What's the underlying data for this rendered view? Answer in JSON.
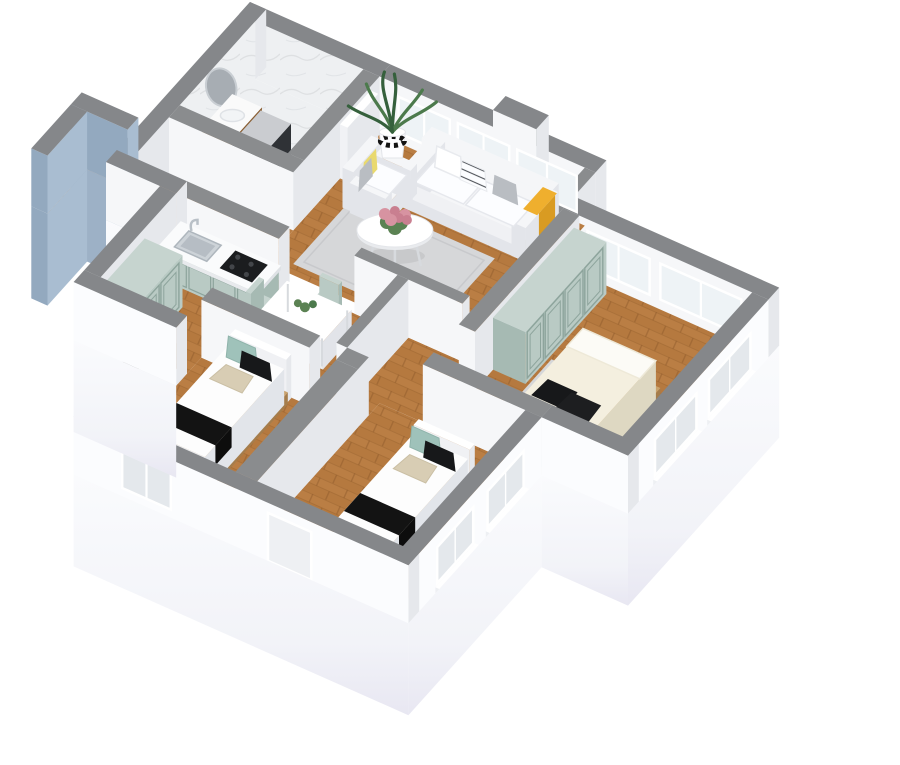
{
  "scene": {
    "description": "3D isometric dollhouse render of an apartment floor plan on a white background, gray-capped cutaway walls, wood floors",
    "rooms": [
      {
        "name": "bathroom",
        "position": "top-left",
        "floor": "white marble",
        "walls": "white marble",
        "furniture": [
          "round wall mirror",
          "wood vanity with sink basin",
          "washing machine"
        ]
      },
      {
        "name": "living-room",
        "position": "top-center",
        "floor": "wood",
        "windows": "three framed windows on north wall",
        "furniture": [
          "white three-seat sofa with white, striped and gray pillows and yellow throw",
          "white armchair with yellow and gray pillows",
          "round white coffee table with pink flower centerpiece",
          "gray area rug",
          "tall green plant in white pot with black checker band",
          "open white door to bathroom"
        ]
      },
      {
        "name": "kitchen-dining",
        "position": "center-left",
        "floor": "wood",
        "furniture": [
          "sage green kitchen counter with steel sink, faucet and black cooktop",
          "white dining table with four sage green chairs and green centerpiece"
        ]
      },
      {
        "name": "hallway",
        "position": "left",
        "floor": "wood",
        "furniture": [
          "sage green wardrobe"
        ],
        "exterior": "blue-gray entry niche panel on west side"
      },
      {
        "name": "master-bedroom",
        "position": "right",
        "floor": "wood",
        "windows": "north wall windows and two east windows with outside sills",
        "furniture": [
          "sage green four-door wardrobe",
          "double bed with cream duvet, white folded sheet, two black pillows and gray headboard",
          "gray rug"
        ]
      },
      {
        "name": "bedroom-2",
        "position": "bottom-center",
        "floor": "wood",
        "furniture": [
          "single bed with white mattress, black stripe blanket, teal, black and beige pillows, wood base"
        ]
      },
      {
        "name": "bedroom-3",
        "position": "bottom-right",
        "floor": "wood",
        "windows": "two east windows and south window and door opening with sills",
        "furniture": [
          "single bed with white mattress, black stripe blanket, teal, black and beige pillows, wood base"
        ]
      }
    ]
  },
  "palette": {
    "bg": "#ffffff",
    "wallTop": "#8a8c8e",
    "wallTopExt": "#85878a",
    "wallFace": "#f6f7f9",
    "wallShade": "#e6e8ec",
    "extFace": "#fbfcfe",
    "skirtTop": "#fafbfd",
    "skirtMid": "#f2f3f8",
    "skirtBottom": "#e8e7f2",
    "wood": "#b5793f",
    "woodLight": "#bd8148",
    "woodDark": "#9c6630",
    "woodSeam": "#8f5c2c",
    "marble": "#eef0f2",
    "marbleVein": "#d9dcdf",
    "sage": "#b9cac4",
    "sageShade": "#a6bab3",
    "sageTop": "#c6d4cf",
    "sageLine": "#8da49c",
    "sofa": "#f5f6f8",
    "sofaShade": "#e3e5ea",
    "sofaDark": "#d7dade",
    "cushion": "#fcfdff",
    "rug": "#d6d7d9",
    "rugLine": "#c8c9cc",
    "bedWood": "#c9a26c",
    "bedWoodShade": "#b18a56",
    "duvet": "#fdfdfd",
    "duvetShade": "#eceef2",
    "duvetDark": "#e2e5ea",
    "duvetCream": "#f4efdf",
    "creamShade": "#e6e0cc",
    "creamDark": "#ded8c2",
    "black": "#131313",
    "teal": "#9fc2ba",
    "beige": "#d8cdb4",
    "grayPillow": "#b9bdc2",
    "yellow": "#e9d96e",
    "yellowDeep": "#efaf2e",
    "yellowShade": "#d99b22",
    "steel": "#cdd3d8",
    "steelDark": "#aeb6bd",
    "cooktop": "#1b1d1f",
    "cabinetWood": "#a97c46",
    "cabinetWoodShade": "#8a5f34",
    "washer": "#3a3d41",
    "washerShade": "#2f3236",
    "washerTop": "#caccd0",
    "niche": "#a9bdd1",
    "nicheShade": "#93a9bf",
    "nicheSkirt": "#9db1c6",
    "mirror": "#a7adb3",
    "plant": "#4c7a4c",
    "plantDark": "#35603c",
    "flower": "#d793a1",
    "flowerDark": "#c97f90",
    "leaf": "#5b8253",
    "headboard": "#bcbfc2",
    "headboardShade": "#a7aaad",
    "pane": "#eef3f6",
    "paneOuter": "#e4e8ec",
    "frame": "#ffffff"
  }
}
